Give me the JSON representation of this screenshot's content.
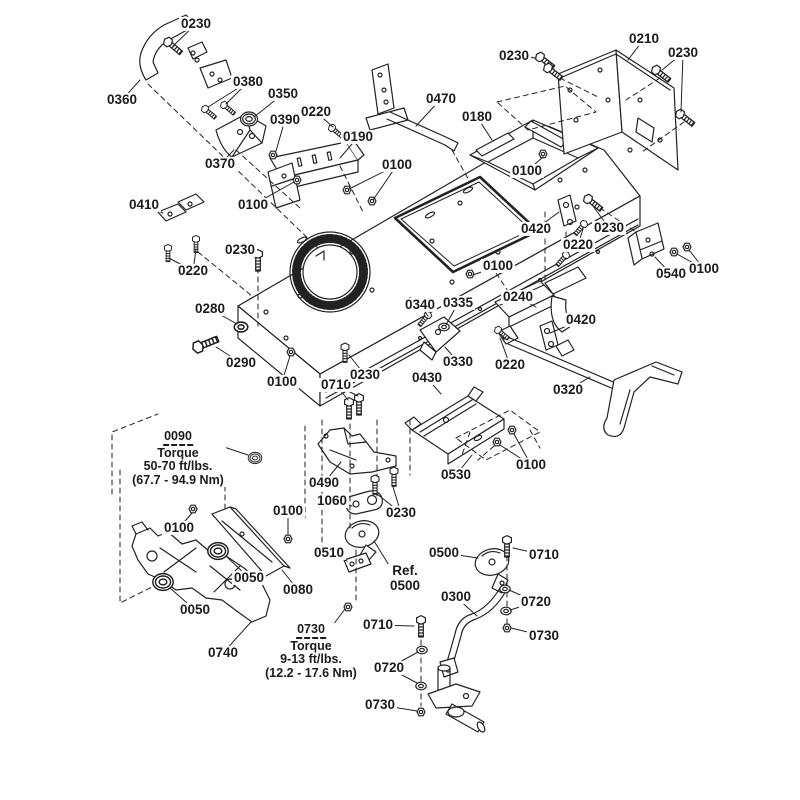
{
  "canvas": {
    "background": "#ffffff",
    "line_color": "#222222"
  },
  "torque_notes": [
    {
      "part": "0090",
      "title": "Torque",
      "spec": "50-70 ft/lbs.",
      "metric": "(67.7 - 94.9 Nm)"
    },
    {
      "part": "0730",
      "title": "Torque",
      "spec": "9-13 ft/lbs.",
      "metric": "(12.2 - 17.6 Nm)"
    }
  ],
  "ref_label": {
    "line1": "Ref.",
    "line2": "0500"
  },
  "labels": [
    {
      "text": "0230",
      "x": 196,
      "y": 24,
      "leaders": [
        [
          173,
          46
        ]
      ]
    },
    {
      "text": "0360",
      "x": 122,
      "y": 100,
      "leaders": [
        [
          140,
          80
        ]
      ]
    },
    {
      "text": "0380",
      "x": 248,
      "y": 82,
      "leaders": [
        [
          208,
          107
        ],
        [
          226,
          104
        ]
      ]
    },
    {
      "text": "0350",
      "x": 283,
      "y": 94,
      "leaders": [
        [
          254,
          117
        ]
      ]
    },
    {
      "text": "0220",
      "x": 316,
      "y": 112,
      "leaders": [
        [
          333,
          127
        ]
      ]
    },
    {
      "text": "0390",
      "x": 285,
      "y": 120,
      "leaders": [
        [
          276,
          151
        ]
      ]
    },
    {
      "text": "0190",
      "x": 358,
      "y": 137,
      "leaders": [
        [
          340,
          158
        ]
      ]
    },
    {
      "text": "0370",
      "x": 220,
      "y": 164,
      "leaders": [
        [
          234,
          150
        ]
      ]
    },
    {
      "text": "0470",
      "x": 441,
      "y": 99,
      "leaders": [
        [
          416,
          126
        ]
      ]
    },
    {
      "text": "0180",
      "x": 477,
      "y": 117,
      "leaders": [
        [
          492,
          140
        ]
      ]
    },
    {
      "text": "0230",
      "x": 514,
      "y": 56,
      "leaders": [
        [
          536,
          58
        ]
      ]
    },
    {
      "text": "0210",
      "x": 644,
      "y": 39,
      "leaders": [
        [
          628,
          60
        ]
      ]
    },
    {
      "text": "0230",
      "x": 683,
      "y": 53,
      "leaders": [
        [
          662,
          70
        ],
        [
          681,
          112
        ]
      ]
    },
    {
      "text": "0100",
      "x": 397,
      "y": 165,
      "leaders": [
        [
          349,
          189
        ],
        [
          373,
          200
        ]
      ]
    },
    {
      "text": "0100",
      "x": 527,
      "y": 171,
      "leaders": [
        [
          543,
          157
        ]
      ]
    },
    {
      "text": "0100",
      "x": 253,
      "y": 205,
      "leaders": [
        [
          294,
          182
        ]
      ]
    },
    {
      "text": "0410",
      "x": 144,
      "y": 205,
      "leaders": [
        [
          163,
          213
        ]
      ]
    },
    {
      "text": "0230",
      "x": 240,
      "y": 250,
      "leaders": [
        [
          256,
          257
        ]
      ]
    },
    {
      "text": "0220",
      "x": 193,
      "y": 271,
      "leaders": [
        [
          169,
          258
        ],
        [
          196,
          249
        ]
      ]
    },
    {
      "text": "0420",
      "x": 536,
      "y": 229,
      "leaders": [
        [
          559,
          212
        ]
      ]
    },
    {
      "text": "0230",
      "x": 609,
      "y": 228,
      "leaders": [
        [
          593,
          206
        ]
      ]
    },
    {
      "text": "0220",
      "x": 578,
      "y": 245,
      "leaders": [
        [
          583,
          229
        ]
      ]
    },
    {
      "text": "0540",
      "x": 671,
      "y": 274,
      "leaders": [
        [
          655,
          257
        ]
      ]
    },
    {
      "text": "0100",
      "x": 704,
      "y": 269,
      "leaders": [
        [
          677,
          254
        ],
        [
          689,
          250
        ]
      ]
    },
    {
      "text": "0100",
      "x": 498,
      "y": 266,
      "leaders": [
        [
          473,
          275
        ]
      ]
    },
    {
      "text": "0280",
      "x": 210,
      "y": 309,
      "leaders": [
        [
          237,
          324
        ]
      ]
    },
    {
      "text": "0290",
      "x": 241,
      "y": 363,
      "leaders": [
        [
          216,
          347
        ]
      ]
    },
    {
      "text": "0100",
      "x": 282,
      "y": 382,
      "leaders": [
        [
          290,
          356
        ]
      ]
    },
    {
      "text": "0710",
      "x": 336,
      "y": 385,
      "leaders": [
        [
          348,
          400
        ],
        [
          358,
          396
        ]
      ]
    },
    {
      "text": "0230",
      "x": 365,
      "y": 375,
      "leaders": [
        [
          349,
          355
        ]
      ]
    },
    {
      "text": "0340",
      "x": 420,
      "y": 305,
      "leaders": [
        [
          428,
          316
        ]
      ]
    },
    {
      "text": "0335",
      "x": 458,
      "y": 303,
      "leaders": [
        [
          446,
          325
        ]
      ]
    },
    {
      "text": "0240",
      "x": 518,
      "y": 297,
      "leaders": [
        [
          536,
          307
        ]
      ]
    },
    {
      "text": "0420",
      "x": 581,
      "y": 320,
      "leaders": [
        [
          550,
          333
        ]
      ]
    },
    {
      "text": "0330",
      "x": 458,
      "y": 362,
      "leaders": [
        [
          445,
          347
        ]
      ]
    },
    {
      "text": "0220",
      "x": 510,
      "y": 365,
      "leaders": [
        [
          500,
          338
        ]
      ]
    },
    {
      "text": "0320",
      "x": 568,
      "y": 390,
      "leaders": [
        [
          590,
          377
        ]
      ]
    },
    {
      "text": "0430",
      "x": 427,
      "y": 378,
      "leaders": [
        [
          441,
          394
        ]
      ]
    },
    {
      "text": "0490",
      "x": 324,
      "y": 483,
      "leaders": [
        [
          341,
          462
        ]
      ]
    },
    {
      "text": "1060",
      "x": 332,
      "y": 501,
      "leaders": [
        [
          352,
          506
        ]
      ]
    },
    {
      "text": "0230",
      "x": 401,
      "y": 513,
      "leaders": [
        [
          377,
          494
        ],
        [
          393,
          487
        ]
      ]
    },
    {
      "text": "0530",
      "x": 456,
      "y": 475,
      "leaders": [
        [
          472,
          455
        ]
      ]
    },
    {
      "text": "0100",
      "x": 531,
      "y": 465,
      "leaders": [
        [
          500,
          445
        ],
        [
          514,
          434
        ]
      ]
    },
    {
      "text": "0100",
      "x": 179,
      "y": 528,
      "leaders": [
        [
          192,
          513
        ]
      ]
    },
    {
      "text": "0100",
      "x": 288,
      "y": 511,
      "leaders": [
        [
          288,
          535
        ]
      ]
    },
    {
      "text": "0050",
      "x": 249,
      "y": 578,
      "leaders": [
        [
          226,
          556
        ]
      ]
    },
    {
      "text": "0080",
      "x": 298,
      "y": 590,
      "leaders": [
        [
          282,
          570
        ]
      ]
    },
    {
      "text": "0050",
      "x": 195,
      "y": 610,
      "leaders": [
        [
          170,
          588
        ]
      ]
    },
    {
      "text": "0740",
      "x": 223,
      "y": 653,
      "leaders": [
        [
          251,
          622
        ]
      ]
    },
    {
      "text": "0510",
      "x": 329,
      "y": 553,
      "leaders": [
        [
          347,
          561
        ]
      ]
    },
    {
      "text": "0500",
      "x": 444,
      "y": 553,
      "leaders": [
        [
          478,
          558
        ]
      ]
    },
    {
      "text": "0300",
      "x": 456,
      "y": 597,
      "leaders": [
        [
          477,
          616
        ]
      ]
    },
    {
      "text": "0710",
      "x": 378,
      "y": 625,
      "leaders": [
        [
          414,
          626
        ]
      ]
    },
    {
      "text": "0720",
      "x": 389,
      "y": 668,
      "leaders": [
        [
          418,
          652
        ],
        [
          417,
          683
        ]
      ]
    },
    {
      "text": "0710",
      "x": 544,
      "y": 555,
      "leaders": [
        [
          513,
          548
        ]
      ]
    },
    {
      "text": "0720",
      "x": 536,
      "y": 602,
      "leaders": [
        [
          509,
          590
        ],
        [
          510,
          610
        ]
      ]
    },
    {
      "text": "0730",
      "x": 544,
      "y": 636,
      "leaders": [
        [
          511,
          628
        ]
      ]
    },
    {
      "text": "0730",
      "x": 380,
      "y": 705,
      "leaders": [
        [
          417,
          711
        ]
      ]
    }
  ]
}
